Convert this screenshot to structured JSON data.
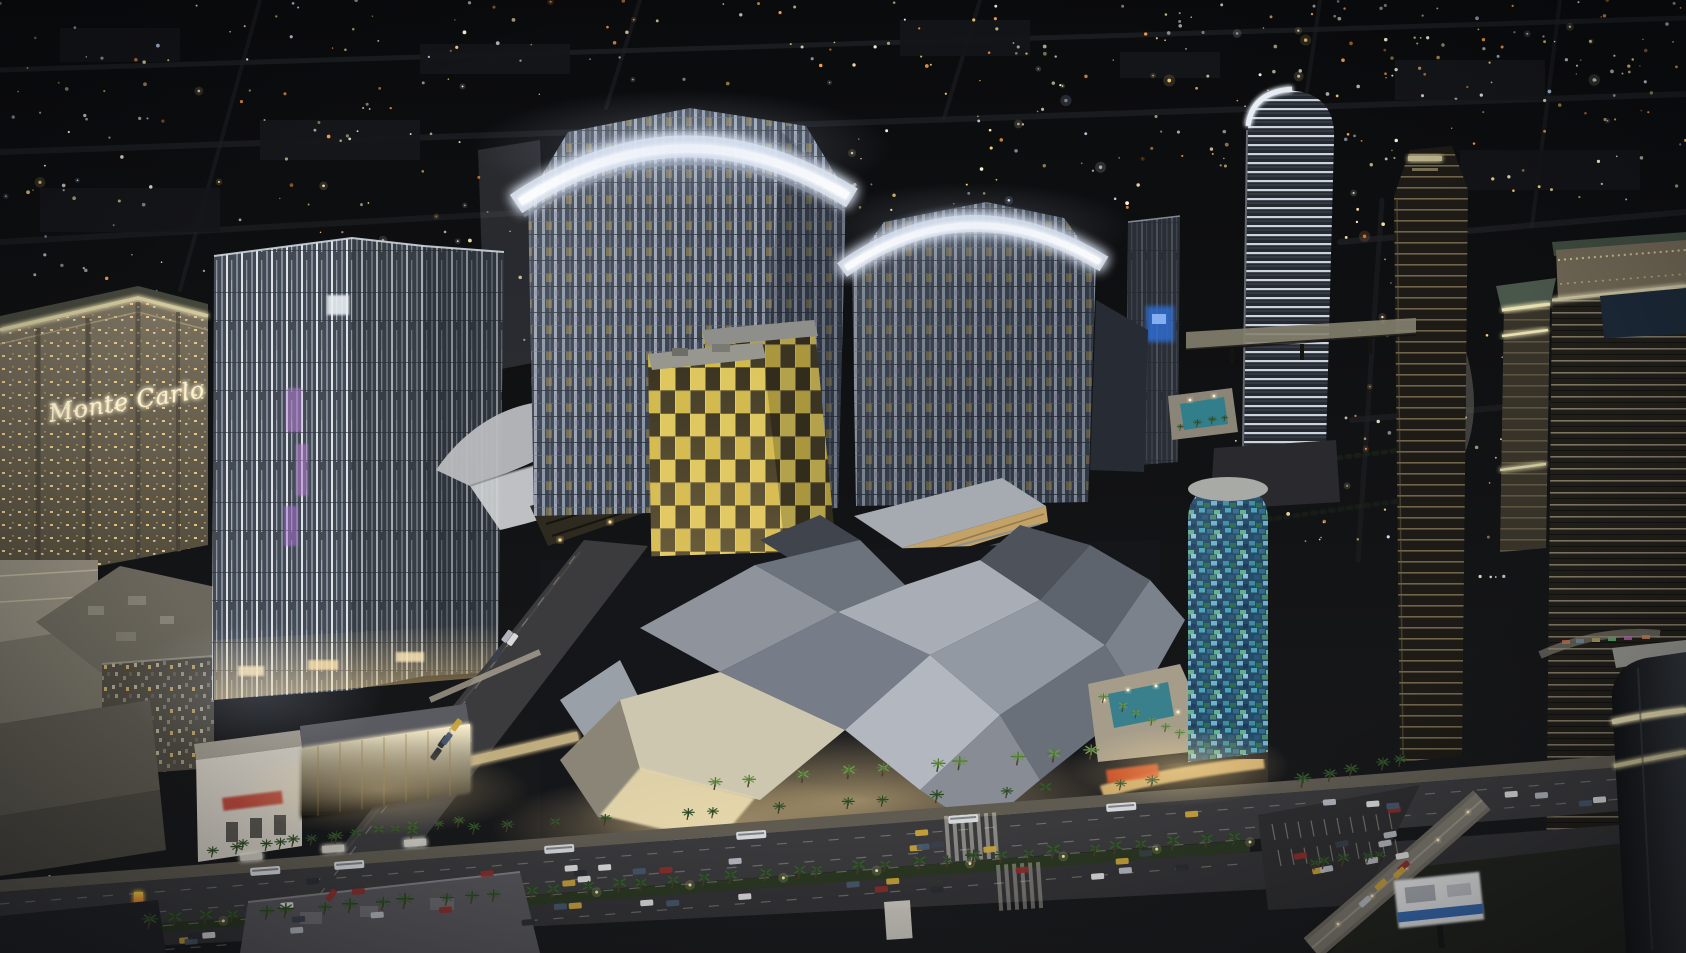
{
  "scene": {
    "title": "Night aerial rendering of a Las Vegas Strip resort complex",
    "description": "Computer rendering viewed from high above at night: curved-crown glass hotel towers with illuminated crowns, two leaning gold-checkered towers, an angular crystalline mall roof glowing warm, an oval tower with blue-green mosaic glass, the beige Monte Carlo hotel at left, dark high-rises at right, and boulevards full of traffic and palm medians stretching into a dark city grid.",
    "signs": {
      "monte_carlo_main": "Monte Carlo",
      "monte_carlo_rooftop": "Monte Carlo"
    },
    "palette": {
      "night_ground": "#0d0e10",
      "city_light_warm": "#ffd27a",
      "city_light_cool": "#cfe2ff",
      "tower_glass": "#3a414d",
      "tower_glass_lit": "#dfe4ea",
      "crown_glow": "#eef2fa",
      "veer_gold": "#d9c257",
      "crystals_steel": "#9aa0ab",
      "crystals_glow": "#ffdf9e",
      "harmon_mosaic": "#3e8ca0",
      "monte_carlo_facade": "#6b6353",
      "sign_glow": "#fff0c2",
      "asphalt": "#38383b",
      "palm_green": "#3f6b34",
      "taxi_yellow": "#c8a23a"
    }
  }
}
